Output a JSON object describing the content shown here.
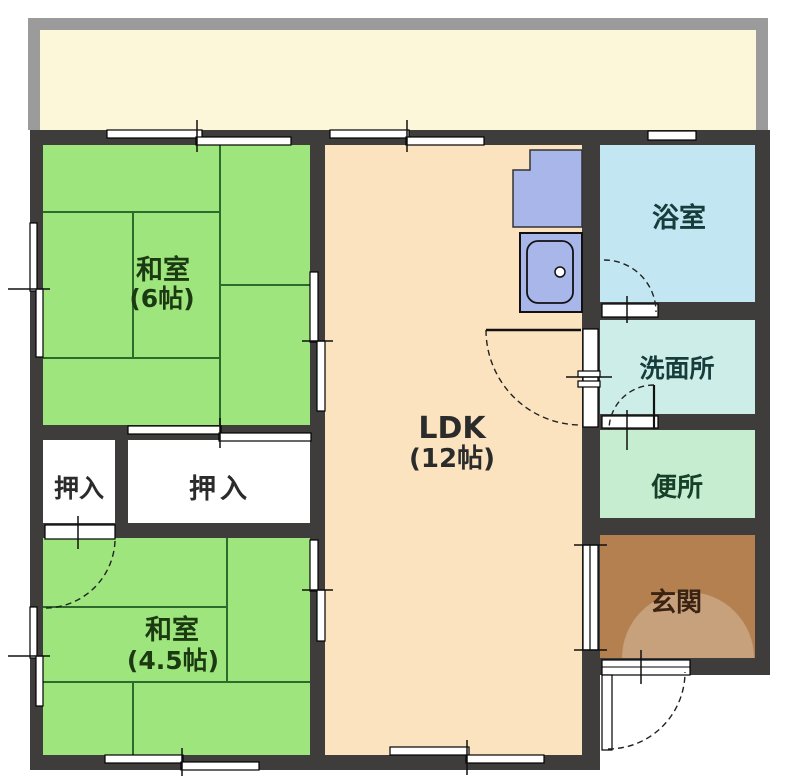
{
  "plan": {
    "balcony_label": "",
    "rooms": {
      "washitsu6": {
        "name": "和室",
        "size": "(6帖)"
      },
      "washitsu45": {
        "name": "和室",
        "size": "(4.5帖)"
      },
      "ldk": {
        "name": "LDK",
        "size": "(12帖)"
      },
      "bath": {
        "name": "浴室"
      },
      "washroom": {
        "name": "洗面所"
      },
      "toilet": {
        "name": "便所"
      },
      "entrance": {
        "name": "玄関"
      },
      "oshiire_left": {
        "name": "押入"
      },
      "oshiire_right": {
        "name": "押入"
      }
    }
  },
  "colors": {
    "wall": "#3e3d3b",
    "balcony_frame": "#9b9b9b",
    "balcony_floor": "#fbf7d8",
    "tatami": "#9fe57d",
    "tatami_line": "#2d6b2d",
    "ldk": "#fce3c0",
    "closet": "#ffffff",
    "bath": "#c3e7f2",
    "washroom": "#cdeee8",
    "toilet": "#c6edcf",
    "entrance": "#b48050",
    "entrance_arc": "rgba(255,255,255,0.25)",
    "kitchen_fixture": "#a9b6ea",
    "opening": "#ffffff",
    "label_green": "#1b3a12",
    "label_neutral": "#2b2b2b",
    "label_bath": "#173c3c",
    "label_toilet": "#17402a",
    "label_entrance": "#3a2313"
  }
}
